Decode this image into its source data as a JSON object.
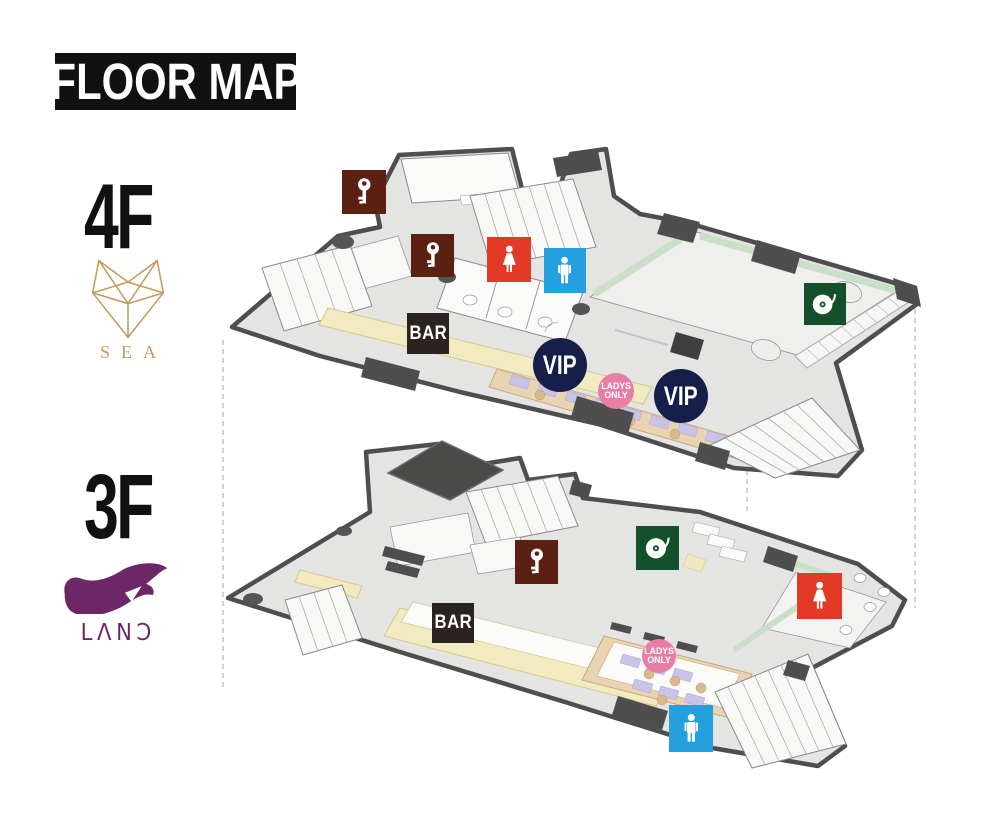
{
  "title": "FLOOR MAP",
  "colors": {
    "banner_bg": "#111111",
    "banner_text": "#FFFFFF",
    "sea_gold": "#C49B5E",
    "land_purple": "#6E2766",
    "key_brown": "#5A2112",
    "womens_red": "#E23A26",
    "mens_blue": "#25A0DF",
    "dj_green": "#14502B",
    "vip_navy": "#151F49",
    "ladys_pink": "#E87EA6",
    "bar_dark": "#2B2320",
    "wall_gray": "#4E4E4E",
    "floor_gray": "#E4E4E3",
    "counter_cream": "#F2EAC0",
    "trim_green": "#C9DFC8",
    "sofa_tan": "#E9D3B2",
    "cushion_lavender": "#C8C4E7"
  },
  "floors": [
    {
      "label": "4F",
      "brand": "SEA",
      "bar_label": "BAR",
      "vip_label": "VIP",
      "ladys_only_lines": [
        "LADYS",
        "ONLY"
      ],
      "icons": [
        "key-icon",
        "key-icon",
        "womens-restroom-icon",
        "mens-restroom-icon",
        "dj-booth-icon"
      ]
    },
    {
      "label": "3F",
      "brand": "LAND",
      "brand_wordmark": "LΛNƆ",
      "bar_label": "BAR",
      "ladys_only_lines": [
        "LADYS",
        "ONLY"
      ],
      "icons": [
        "key-icon",
        "dj-booth-icon",
        "womens-restroom-icon",
        "mens-restroom-icon"
      ]
    }
  ]
}
